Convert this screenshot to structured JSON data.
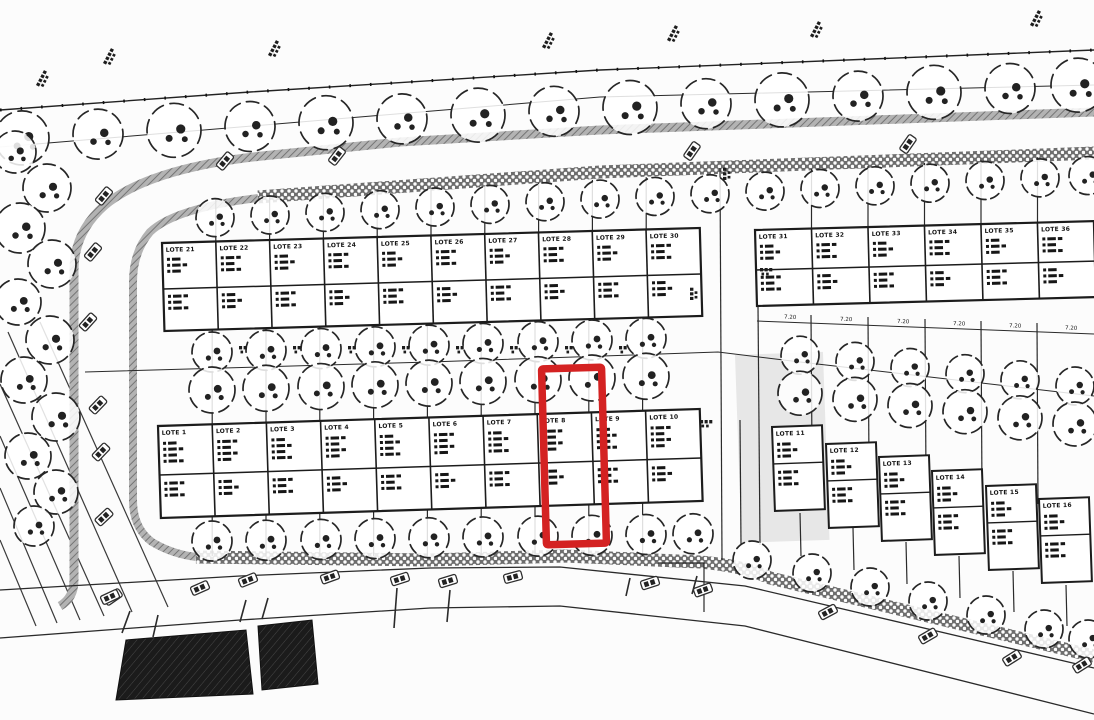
{
  "plan": {
    "type": "loteamento-site-plan",
    "paper_color": "#fcfcfc",
    "ink_color": "#1c1c1c",
    "highlight": {
      "lot": "LOTE 8",
      "color": "#d42222"
    },
    "blocks": {
      "top_left": [
        "LOTE 21",
        "LOTE 22",
        "LOTE 23",
        "LOTE 24",
        "LOTE 25",
        "LOTE 26",
        "LOTE 27",
        "LOTE 28",
        "LOTE 29",
        "LOTE 30"
      ],
      "top_right": [
        "LOTE 31",
        "LOTE 32",
        "LOTE 33",
        "LOTE 34",
        "LOTE 35",
        "LOTE 36"
      ],
      "bottom_left": [
        "LOTE 1",
        "LOTE 2",
        "LOTE 3",
        "LOTE 4",
        "LOTE 5",
        "LOTE 6",
        "LOTE 7",
        "LOTE 8",
        "LOTE 9",
        "LOTE 10"
      ],
      "bottom_right": [
        "LOTE 11",
        "LOTE 12",
        "LOTE 13",
        "LOTE 14",
        "LOTE 15",
        "LOTE 16"
      ]
    },
    "dimensions": {
      "lot_width_labels": [
        "7.20",
        "7.20",
        "7.20",
        "7.20",
        "7.20",
        "7.20"
      ]
    }
  }
}
